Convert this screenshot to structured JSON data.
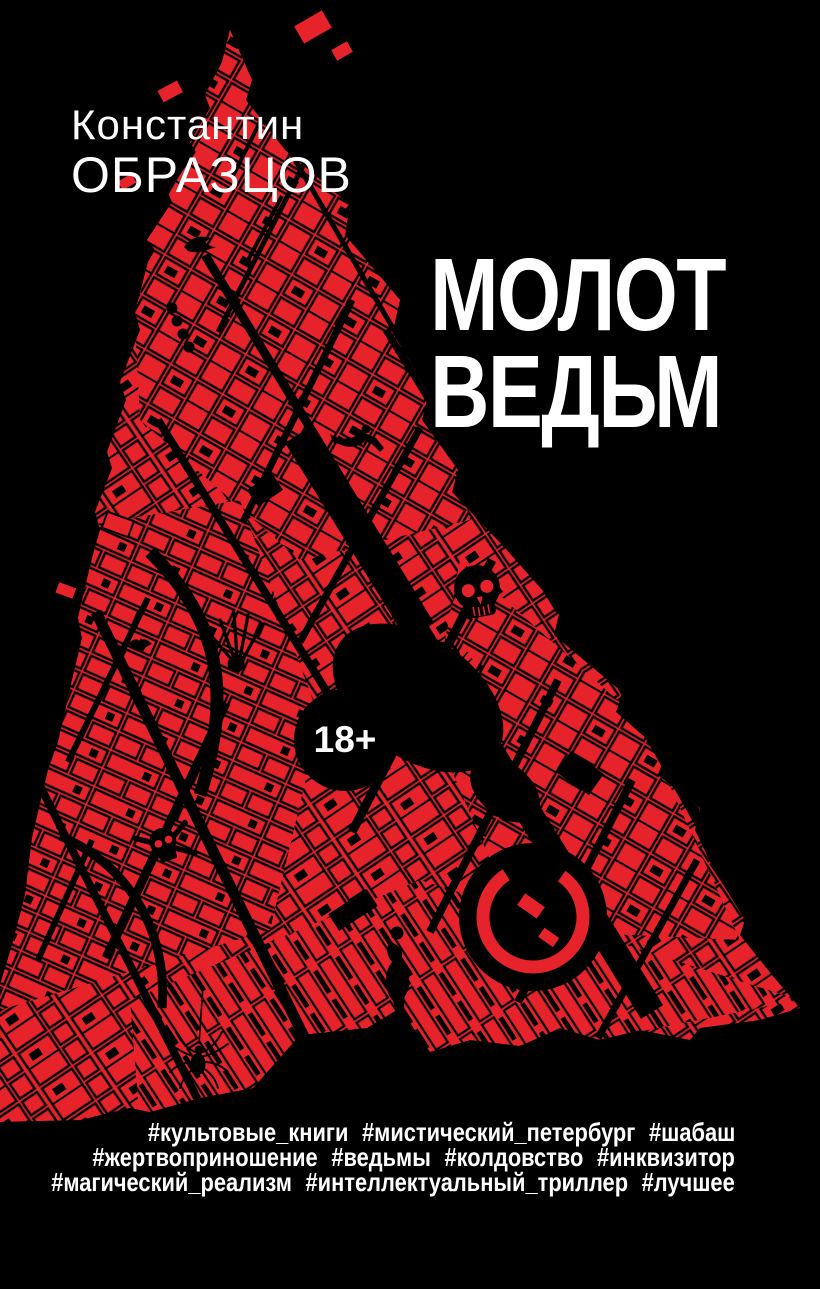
{
  "cover": {
    "author": {
      "line1": "Константин",
      "line2": "ОБРАЗЦОВ"
    },
    "title": {
      "line1": "МОЛОТ",
      "line2": "ВЕДЬМ"
    },
    "age_badge": "18+",
    "hashtags": {
      "line1": "#культовые_книги #мистический_петербург #шабаш",
      "line2": "#жертвоприношение #ведьмы #колдовство #инквизитор",
      "line3": "#магический_реализм #интеллектуальный_триллер #лучшее"
    },
    "colors": {
      "background": "#000000",
      "map_red": "#e6232b",
      "text": "#ffffff",
      "ink": "#000000"
    },
    "map_icons": [
      "skull-icon",
      "skull-crossbones-icon",
      "spider-icon",
      "scorpion-icon",
      "skeleton-hand-icon",
      "woman-silhouette-icon",
      "falling-figure-icon",
      "raven-icon",
      "bat-icon"
    ]
  }
}
